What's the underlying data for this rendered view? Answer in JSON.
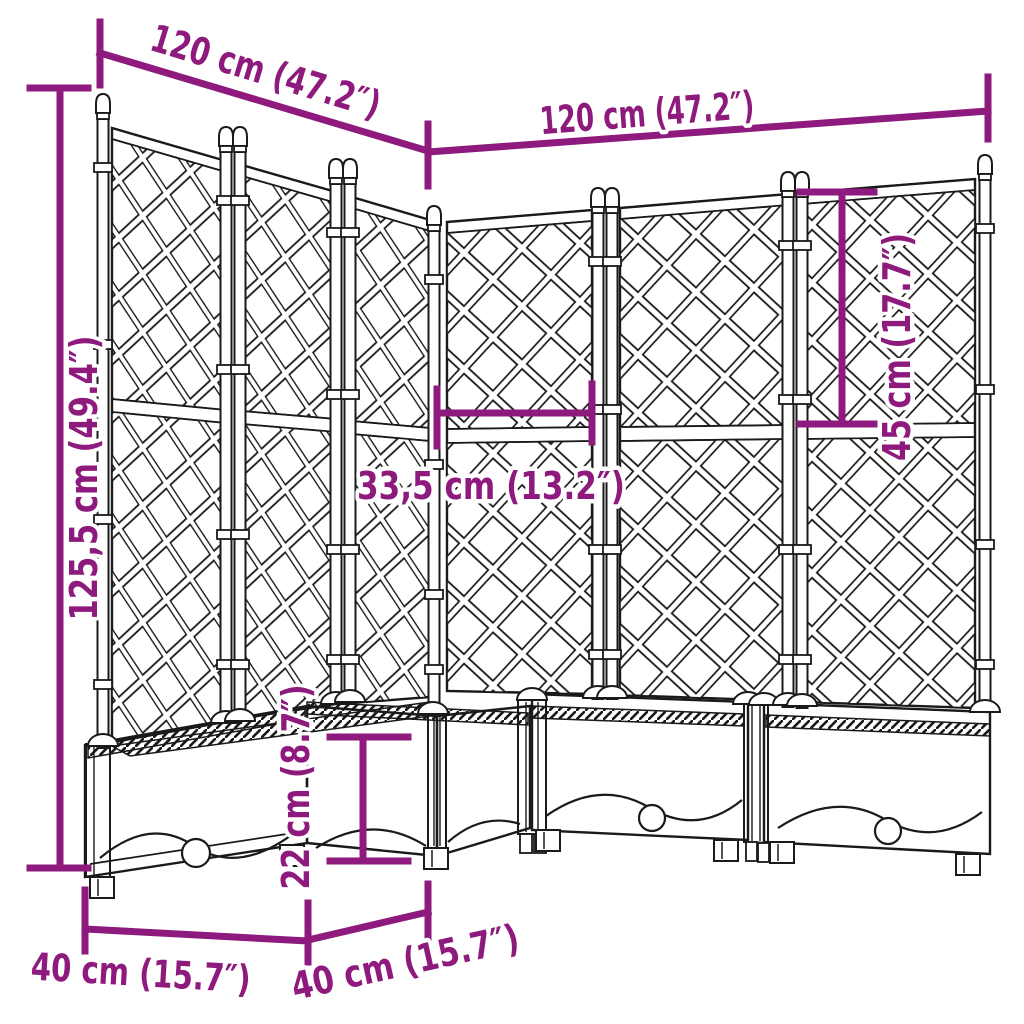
{
  "diagram": {
    "type": "product-dimension-diagram",
    "subject": "corner garden planter with trellis",
    "colors": {
      "dimension_annotation": "#8e1a7d",
      "line_art": "#1a1a1a",
      "background": "#ffffff"
    },
    "dimensions": {
      "left_wing_width": "120 cm (47.2″)",
      "right_wing_width": "120 cm (47.2″)",
      "total_height": "125,5 cm (49.4″)",
      "trellis_upper_section_height": "45 cm (17.7″)",
      "panel_section_width": "33,5 cm (13.2″)",
      "planter_box_height": "22 cm (8.7″)",
      "planter_depth_front": "40 cm (15.7″)",
      "planter_depth_side": "40 cm (15.7″)"
    }
  }
}
